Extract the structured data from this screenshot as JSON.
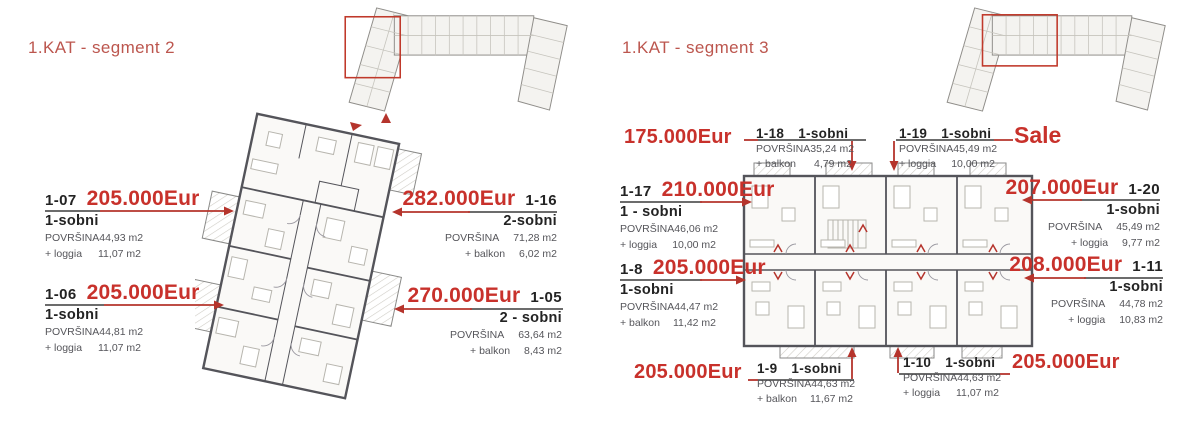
{
  "labels": {
    "area": "POVRŠINA"
  },
  "colors": {
    "accent_title": "#bc564e",
    "price_red": "#c8312b",
    "arrow_red": "#b5342c",
    "highlight_box": "#c0392b"
  },
  "segment2": {
    "title": "1.KAT - segment 2",
    "apartments": {
      "a107": {
        "id": "1-07",
        "price": "205.000Eur",
        "type": "1-sobni",
        "area": "44,93 m2",
        "extra_label": "+ loggia",
        "extra": "11,07 m2"
      },
      "a106": {
        "id": "1-06",
        "price": "205.000Eur",
        "type": "1-sobni",
        "area": "44,81 m2",
        "extra_label": "+ loggia",
        "extra": "11,07 m2"
      },
      "a116": {
        "id": "1-16",
        "price": "282.000Eur",
        "type": "2-sobni",
        "area": "71,28 m2",
        "extra_label": "+ balkon",
        "extra": "6,02 m2"
      },
      "a105": {
        "id": "1-05",
        "price": "270.000Eur",
        "type": "2 - sobni",
        "area": "63,64 m2",
        "extra_label": "+ balkon",
        "extra": "8,43 m2"
      }
    }
  },
  "segment3": {
    "title": "1.KAT - segment 3",
    "apartments": {
      "a117": {
        "id": "1-17",
        "price": "210.000Eur",
        "type": "1 - sobni",
        "area": "46,06 m2",
        "extra_label": "+ loggia",
        "extra": "10,00 m2"
      },
      "a18": {
        "id": "1-8",
        "price": "205.000Eur",
        "type": "1-sobni",
        "area": "44,47 m2",
        "extra_label": "+ balkon",
        "extra": "11,42 m2"
      },
      "a118": {
        "id": "1-18",
        "price": "175.000Eur",
        "type": "1-sobni",
        "area": "35,24 m2",
        "extra_label": "+ balkon",
        "extra": "4,79 m2"
      },
      "a119": {
        "id": "1-19",
        "price": "Sale",
        "type": "1-sobni",
        "area": "45,49 m2",
        "extra_label": "+ loggia",
        "extra": "10,00 m2"
      },
      "a120": {
        "id": "1-20",
        "price": "207.000Eur",
        "type": "1-sobni",
        "area": "45,49 m2",
        "extra_label": "+ loggia",
        "extra": "9,77 m2"
      },
      "a111": {
        "id": "1-11",
        "price": "208.000Eur",
        "type": "1-sobni",
        "area": "44,78 m2",
        "extra_label": "+ loggia",
        "extra": "10,83 m2"
      },
      "a19": {
        "id": "1-9",
        "price": "205.000Eur",
        "type": "1-sobni",
        "area": "44,63 m2",
        "extra_label": "+ balkon",
        "extra": "11,67 m2"
      },
      "a110": {
        "id": "1-10",
        "price": "205.000Eur",
        "type": "1-sobni",
        "area": "44,63 m2",
        "extra_label": "+ loggia",
        "extra": "11,07 m2"
      }
    }
  }
}
